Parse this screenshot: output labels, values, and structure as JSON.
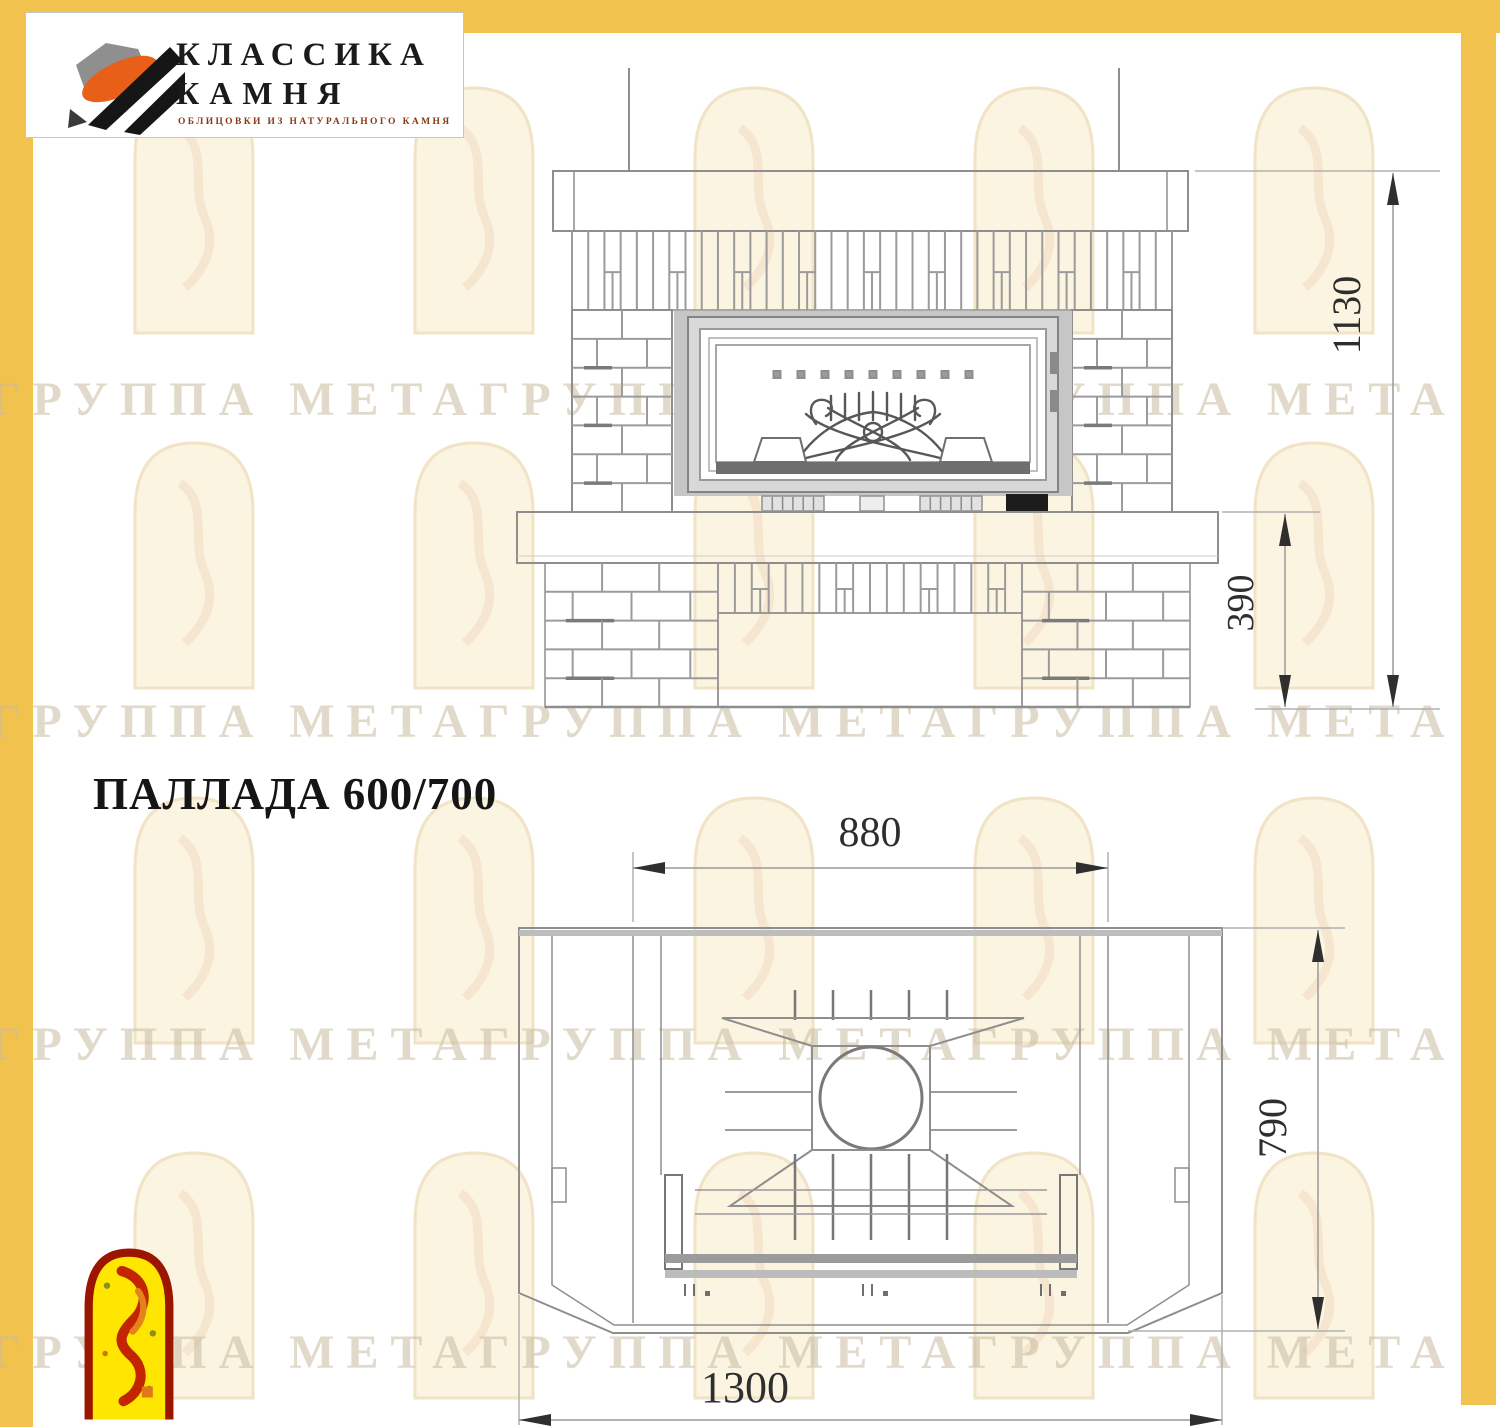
{
  "title": "ПАЛЛАДА 600/700",
  "brand": {
    "line1": "КЛАССИКА",
    "line2": "КАМНЯ",
    "tagline": "ОБЛИЦОВКИ ИЗ НАТУРАЛЬНОГО КАМНЯ"
  },
  "watermark": {
    "text": "ГРУППА МЕТАГРУППА МЕТАГРУППА МЕТА"
  },
  "views": {
    "front": {
      "label": "front-elevation",
      "dimensions": {
        "height_total": {
          "value": "1130"
        },
        "bench_height": {
          "value": "390"
        }
      }
    },
    "plan": {
      "label": "top-plan",
      "dimensions": {
        "body_width": {
          "value": "880"
        },
        "depth": {
          "value": "790"
        },
        "total_width": {
          "value": "1300"
        }
      }
    }
  },
  "colors": {
    "frame_yellow": "#F2C24F",
    "line_gray": "#8e8e8e",
    "accent_orange": "#E85F17",
    "logo_red": "#9B1500",
    "logo_yellow": "#FFE600"
  }
}
